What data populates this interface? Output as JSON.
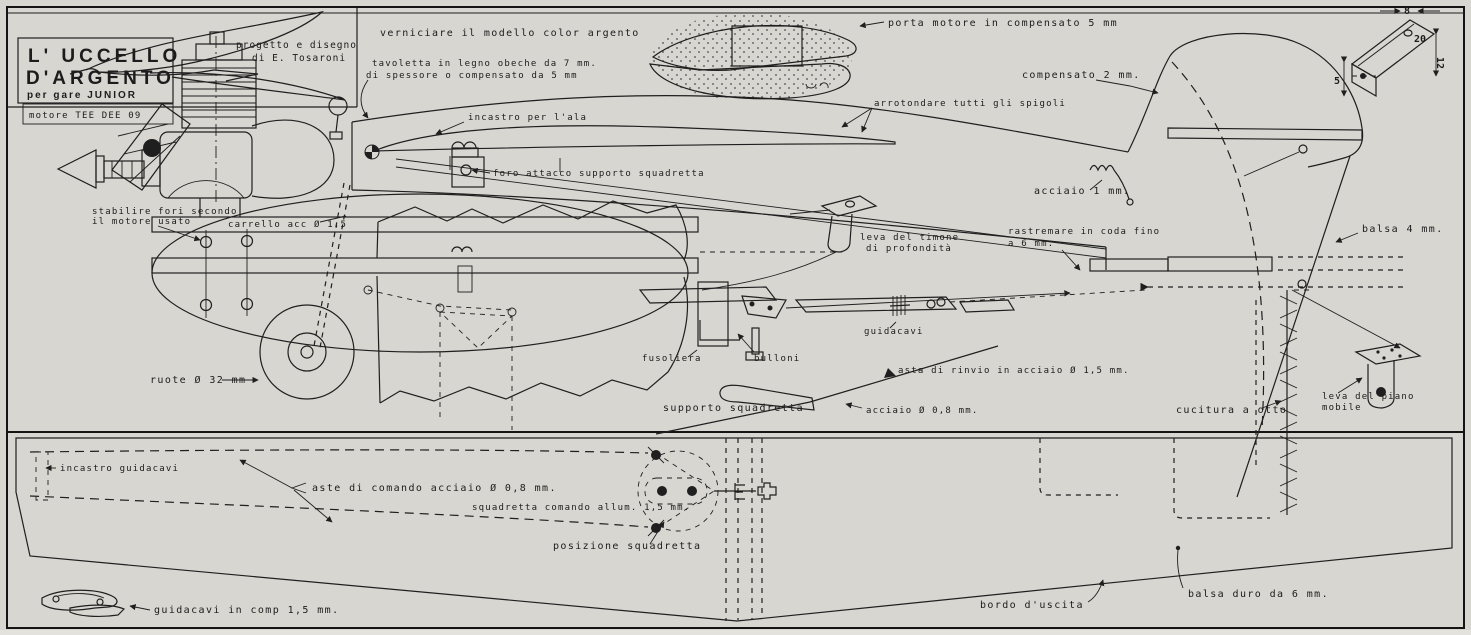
{
  "sheet": {
    "paper_color": "#d7d6d1",
    "ink_color": "#1f1f1f"
  },
  "title_block": {
    "title_line1": "L' UCCELLO",
    "title_line2": "D'ARGENTO",
    "subtitle": "per gare JUNIOR",
    "credit_line1": "progetto e disegno",
    "credit_line2": "di E. Tosaroni",
    "motor": "motore TEE DEE 09"
  },
  "labels": {
    "verniciare": "verniciare il modello color argento",
    "tavoletta_1": "tavoletta in legno obeche da 7 mm.",
    "tavoletta_2": "di spessore o compensato da 5 mm",
    "porta_motore": "porta motore in compensato  5  mm",
    "compensato2": "compensato 2 mm.",
    "arrotondare": "arrotondare  tutti  gli  spigoli",
    "incastro_ala": "incastro per l'ala",
    "foro_attacco": "foro attacco supporto squadretta",
    "stabilire_1": "stabilire fori secondo",
    "stabilire_2": "il motore usato",
    "carrello": "carrello acc  Ø  1,5",
    "acciaio1": "acciaio  1  mm.",
    "rastremare_1": "rastremare in coda fino",
    "rastremare_2": "a  6  mm.",
    "balsa4": "balsa  4  mm.",
    "leva_timone_1": "leva del timone",
    "leva_timone_2": "di profondità",
    "guidacavi": "guidacavi",
    "ruote": "ruote  Ø  32 mm",
    "fusoliera": "fusoliera",
    "bulloni": "bulloni",
    "supporto_squadretta": "supporto squadretta",
    "asta_rinvio": "asta di rinvio in acciaio  Ø  1,5 mm.",
    "acciaio08": "acciaio  Ø  0,8 mm.",
    "cucitura": "cucitura a otto",
    "leva_piano_1": "leva  del  piano",
    "leva_piano_2": "mobile",
    "incastro_guidacavi": "incastro guidacavi",
    "aste_comando": "aste di comando acciaio  Ø  0,8 mm.",
    "squadretta_comando": "squadretta comando allum. 1,5 mm.",
    "posizione_squadretta": "posizione  squadretta",
    "bordo_uscita": "bordo  d'uscita",
    "balsa_duro": "balsa duro da  6  mm.",
    "guidacavi_comp": "guidacavi in comp  1,5  mm."
  },
  "dimensions": {
    "d8": "8",
    "d20": "20",
    "d12": "12",
    "d5": "5"
  }
}
